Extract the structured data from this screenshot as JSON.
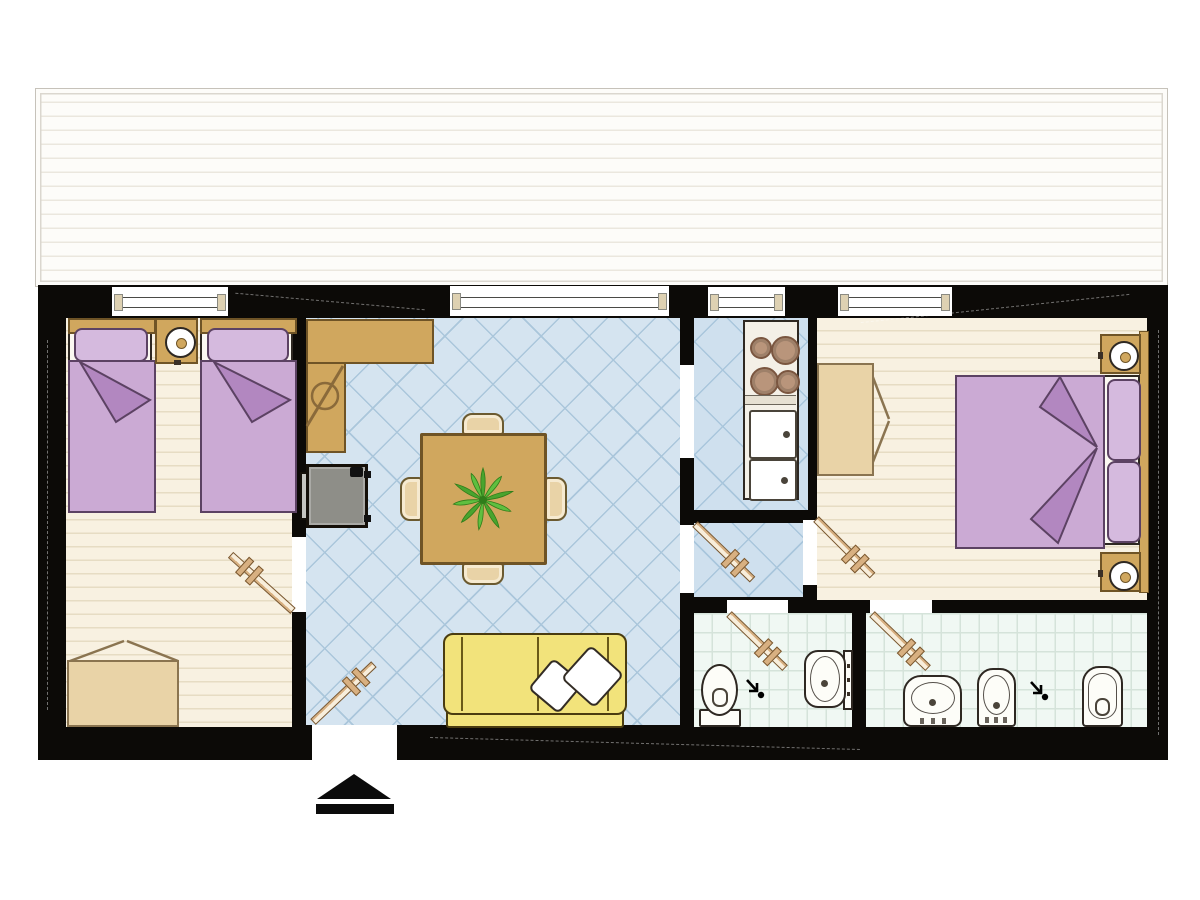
{
  "scene": {
    "type": "apartment-floor-plan",
    "entrance_marker": "up-arrow",
    "rooms": [
      {
        "name": "terrace",
        "items": [
          "deck-planks"
        ]
      },
      {
        "name": "bedroom-left",
        "items": [
          "single-bed",
          "single-bed",
          "nightstand",
          "table-lamp",
          "wardrobe",
          "door",
          "window"
        ]
      },
      {
        "name": "living-room",
        "items": [
          "l-shaped-counter",
          "wood-stove",
          "dining-table",
          "chair",
          "chair",
          "chair",
          "chair",
          "potted-plant",
          "sofa",
          "throw-pillow",
          "throw-pillow",
          "entrance-door",
          "window"
        ]
      },
      {
        "name": "kitchen",
        "items": [
          "cooktop-four-burners",
          "double-sink",
          "window"
        ]
      },
      {
        "name": "hallway",
        "items": [
          "door"
        ]
      },
      {
        "name": "bedroom-right",
        "items": [
          "double-bed",
          "nightstand",
          "nightstand",
          "table-lamp",
          "table-lamp",
          "wardrobe",
          "door",
          "window"
        ]
      },
      {
        "name": "bathroom-left",
        "items": [
          "toilet",
          "washbasin",
          "floor-drain",
          "door"
        ]
      },
      {
        "name": "bathroom-right",
        "items": [
          "washbasin",
          "bidet",
          "floor-drain",
          "toilet",
          "door"
        ]
      }
    ]
  },
  "colors": {
    "paper": "#ffffff",
    "wall": "#0c0a07",
    "terrace_bg": "#fdfcf9",
    "terrace_line": "#ebe7de",
    "terrace_border": "#c6c2ba",
    "floor_bed": "#f8f1e1",
    "floor_bed_line": "#e6dcc3",
    "floor_living": "#d5e4f0",
    "floor_living_line": "#aac6db",
    "floor_kitchen": "#cfe0ee",
    "floor_kitchen_line": "#a9c6dc",
    "floor_bath": "#f0f8f3",
    "floor_bath_line": "#d5e3da",
    "outline": "#2e2822",
    "tan": "#d0a75e",
    "tan_dark": "#6f5426",
    "tan_light": "#e9d3a7",
    "wardrobe_line": "#8a7450",
    "purple": "#cbaad4",
    "purple_light": "#d5bade",
    "purple_fold": "#b287c0",
    "purple_dark": "#5c4263",
    "sheet": "#fbf8f1",
    "sofa": "#f2e37b",
    "sofa_dark": "#4a3c10",
    "stove": "#8e8e88",
    "stove_light": "#c6c6c0",
    "plant": "#49a42e",
    "plant_mid": "#5fbf3f",
    "plant_dark": "#2f7d1a",
    "burner": "#b9957b",
    "burner_dark": "#7a5640",
    "door_leaf": "#d8b081",
    "door_leaf_mid": "#f8eedb",
    "door_leaf_dark": "#7a5830",
    "fixture": "#fdfdf8"
  }
}
